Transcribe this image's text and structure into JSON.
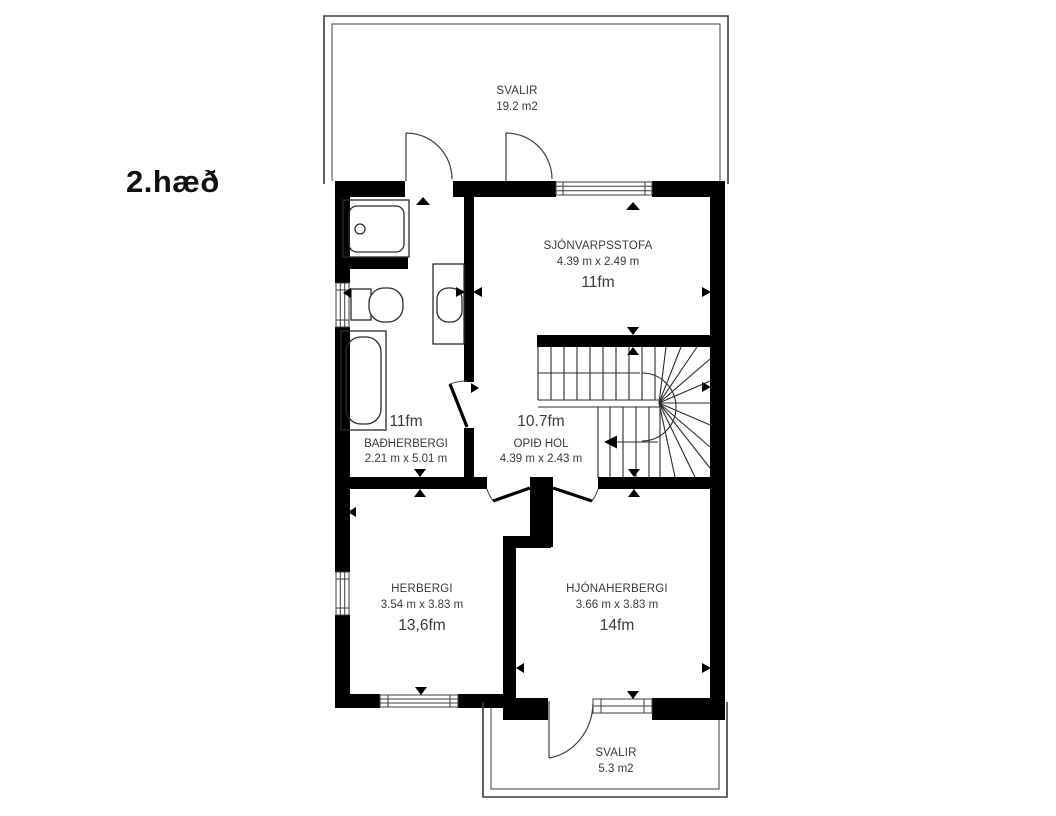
{
  "title": "2.hæð",
  "rooms": {
    "svalir_top": {
      "name": "SVALIR",
      "area": "19.2 m2"
    },
    "sjonvarpsstofa": {
      "name": "SJÓNVARPSSTOFA",
      "dims": "4.39 m x 2.49 m",
      "area": "11fm"
    },
    "badherbergi": {
      "name": "BAÐHERBERGI",
      "dims": "2.21 m x 5.01 m",
      "area": "11fm"
    },
    "opid_hol": {
      "name": "OPIÐ HOL",
      "dims": "4.39 m x 2.43 m",
      "area": "10.7fm"
    },
    "herbergi": {
      "name": "HERBERGI",
      "dims": "3.54 m x 3.83 m",
      "area": "13,6fm"
    },
    "hjonaherbergi": {
      "name": "HJÓNAHERBERGI",
      "dims": "3.66 m x 3.83 m",
      "area": "14fm"
    },
    "svalir_bottom": {
      "name": "SVALIR",
      "area": "5.3 m2"
    }
  },
  "colors": {
    "wall": "#000000",
    "background": "#ffffff",
    "text": "#3a3a3a",
    "line": "#3d3d3d"
  }
}
